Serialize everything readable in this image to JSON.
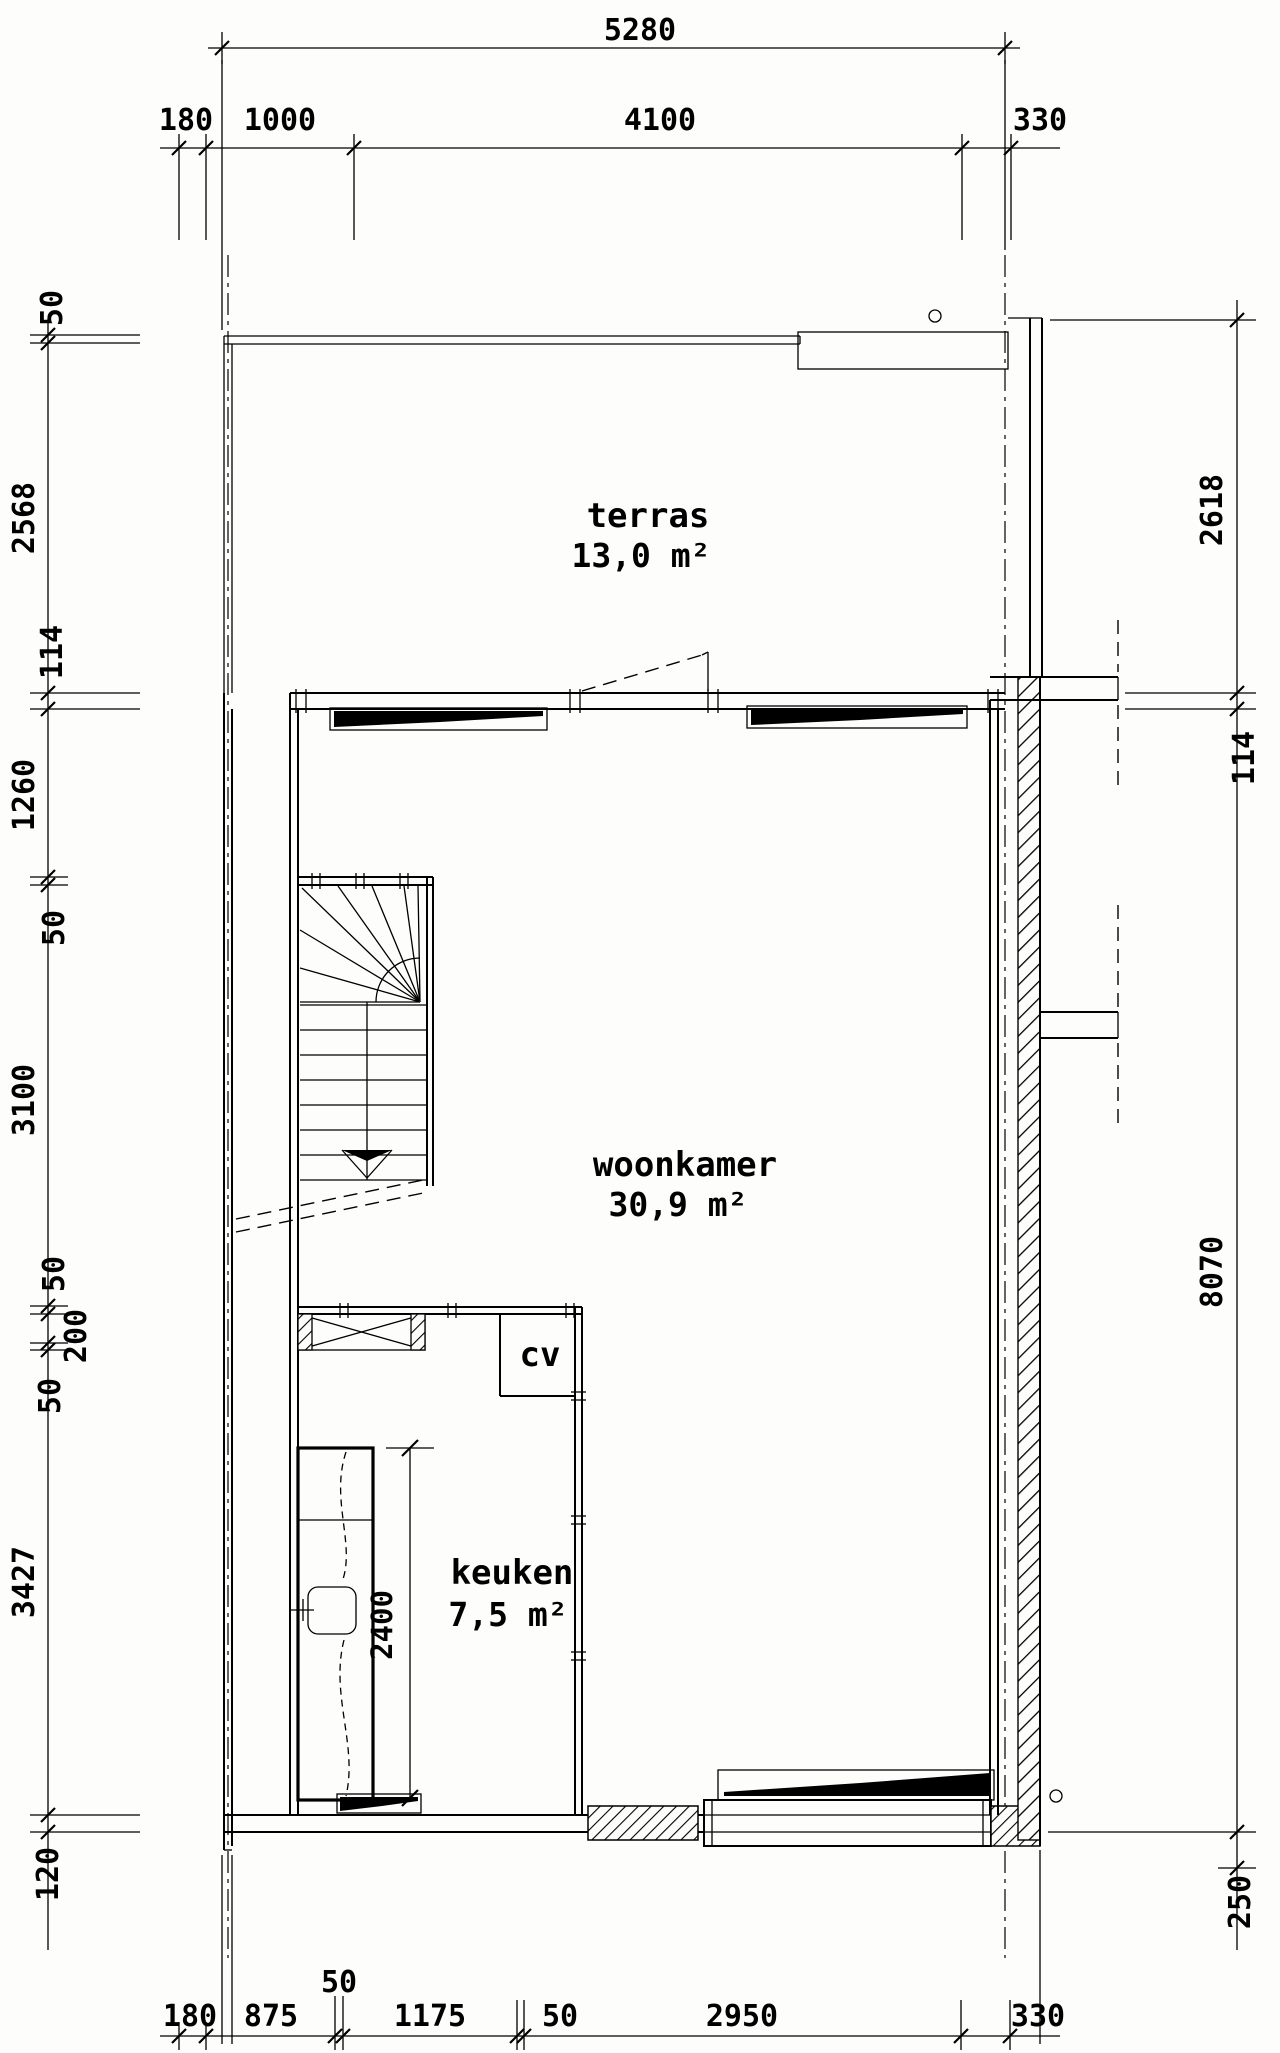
{
  "floorplan": {
    "rooms": [
      {
        "label": "terras",
        "area": "13,0 m²"
      },
      {
        "label": "woonkamer",
        "area": "30,9 m²"
      },
      {
        "label": "keuken",
        "area": "7,5 m²"
      }
    ],
    "fixtures": {
      "cv_label": "cv",
      "counter_dim": "2400"
    },
    "dims": {
      "top_total": "5280",
      "top": [
        "180",
        "1000",
        "4100",
        "330"
      ],
      "bottom": [
        "180",
        "875",
        "50",
        "1175",
        "50",
        "2950",
        "330"
      ],
      "left": [
        "50",
        "2568",
        "114",
        "1260",
        "50",
        "3100",
        "50",
        "200",
        "50",
        "3427",
        "120"
      ],
      "right": [
        "2618",
        "114",
        "8070",
        "250"
      ]
    },
    "colors": {
      "ink": "#000000",
      "paper": "#fdfdfc"
    }
  }
}
